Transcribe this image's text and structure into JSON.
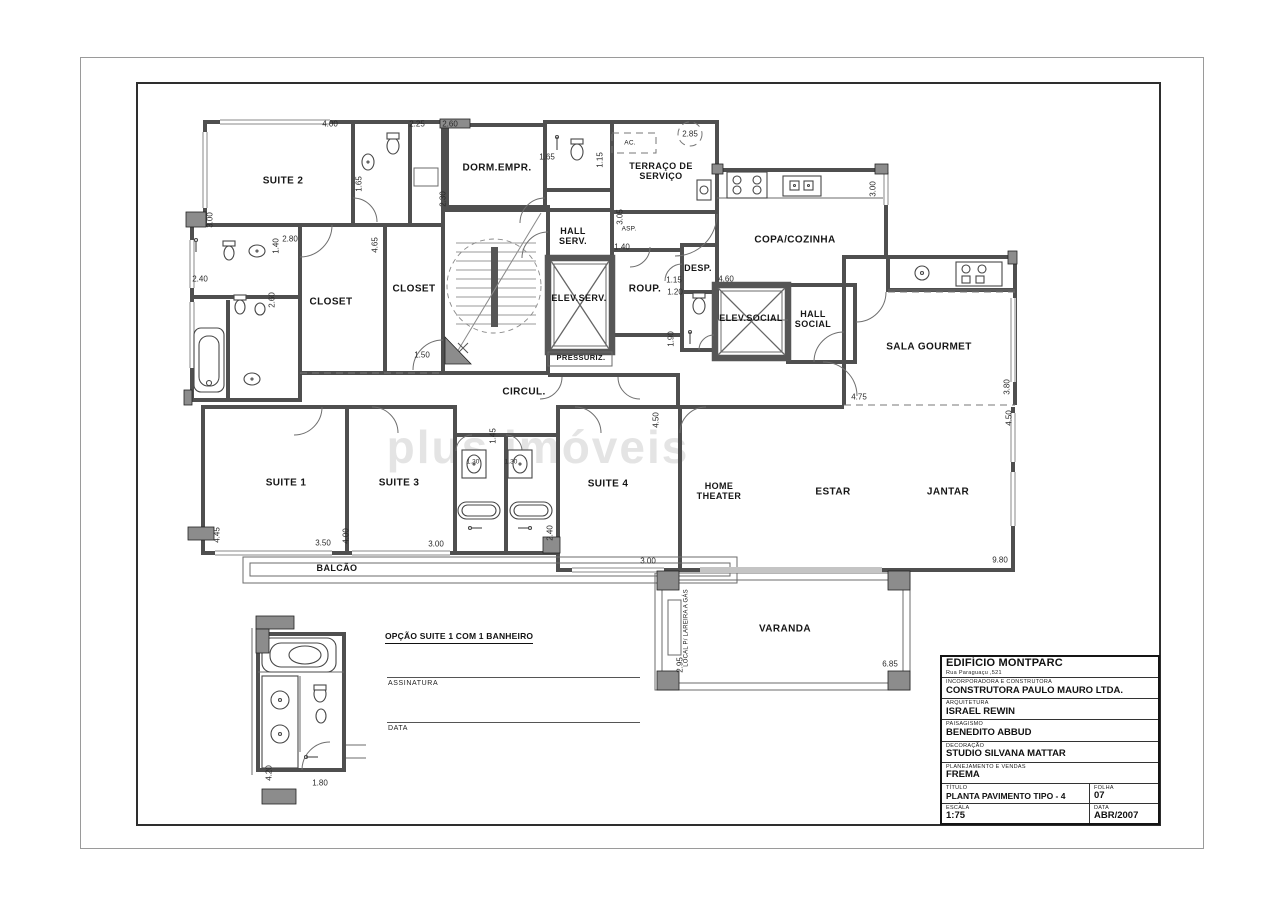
{
  "watermark": "plus imóveis",
  "plan": {
    "rooms": {
      "suite2": "SUITE 2",
      "dorm_empr": "DORM.EMPR.",
      "terraco": "TERRAÇO DE SERVIÇO",
      "copa_cozinha": "COPA/COZINHA",
      "hall_serv": "HALL SERV.",
      "elev_serv": "ELEV.SERV.",
      "pressuriz": "PRESSURIZ.",
      "closet_a": "CLOSET",
      "closet_b": "CLOSET",
      "desp": "DESP.",
      "roup": "ROUP.",
      "elev_social": "ELEV.SOCIAL",
      "hall_social": "HALL SOCIAL",
      "sala_gourmet": "SALA GOURMET",
      "circul": "CIRCUL.",
      "suite1": "SUITE 1",
      "suite3": "SUITE 3",
      "suite4": "SUITE 4",
      "home_theater": "HOME THEATER",
      "estar": "ESTAR",
      "jantar": "JANTAR",
      "balcao": "BALCÃO",
      "varanda": "VARANDA",
      "lareira": "LOCAL P/ LAREIRA A GÁS",
      "ac": "AC.",
      "asp": "ASP."
    },
    "dims": [
      "4.00",
      "2.25",
      "2.60",
      "1.65",
      "1.15",
      "2.85",
      "3.00",
      "2.30",
      "1.65",
      "2.40",
      "2.80",
      "1.40",
      "2.60",
      "4.65",
      "1.50",
      "3.05",
      "1.40",
      "1.15",
      "1.20",
      "4.60",
      "3.00",
      "1.90",
      "4.75",
      "3.80",
      "1.45",
      "2.40",
      "4.50",
      "4.50",
      "4.45",
      "3.50",
      "4.00",
      "3.00",
      "3.00",
      "9.80",
      "2.95",
      "6.85",
      "1.30",
      "1.30",
      "4.20",
      "1.80"
    ]
  },
  "detail": {
    "title": "OPÇÃO SUITE 1 COM 1 BANHEIRO",
    "signature_label": "ASSINATURA",
    "date_label": "DATA"
  },
  "title_block": {
    "building": "EDIFÍCIO MONTPARC",
    "address": "Rua Paraguaçu ,521",
    "rows": [
      {
        "label": "INCORPORADORA E CONSTRUTORA",
        "value": "CONSTRUTORA PAULO MAURO LTDA."
      },
      {
        "label": "ARQUITETURA",
        "value": "ISRAEL REWIN"
      },
      {
        "label": "PAISAGISMO",
        "value": "BENEDITO ABBUD"
      },
      {
        "label": "DECORAÇÃO",
        "value": "STUDIO SILVANA MATTAR"
      },
      {
        "label": "PLANEJAMENTO E VENDAS",
        "value": "FREMA"
      }
    ],
    "titulo_label": "TÍTULO",
    "titulo": "PLANTA PAVIMENTO TIPO - 4 SUÍTES",
    "folha_label": "FOLHA",
    "folha": "07",
    "escala_label": "ESCALA",
    "escala": "1:75",
    "data_label": "DATA",
    "data": "ABR/2007"
  }
}
